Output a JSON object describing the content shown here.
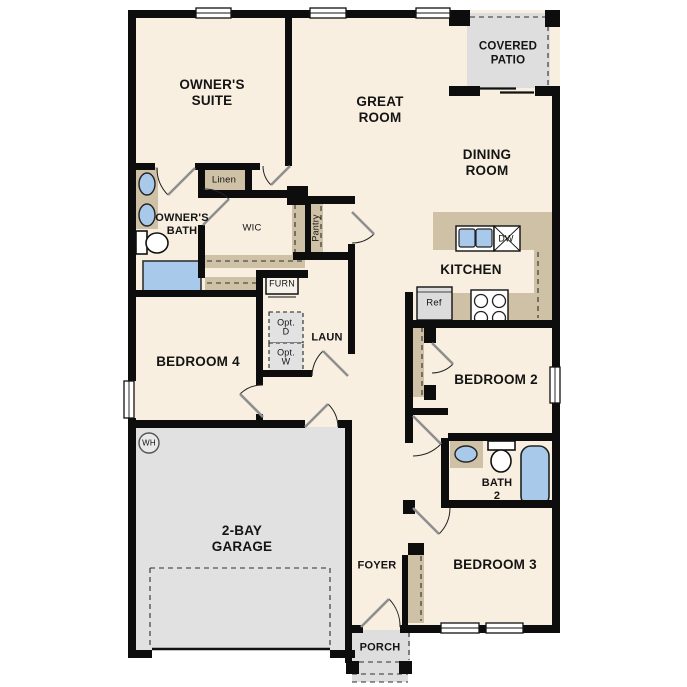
{
  "colors": {
    "floor": "#f8efe1",
    "wall": "#0d0d0d",
    "counter_tan": "#cfc1a6",
    "garage_gray": "#e1e1e1",
    "patio_gray": "#dedede",
    "fixture_blue": "#a9c9ea",
    "appliance_gray": "#dcdcdc",
    "door_leaf_gray": "#8f8f8f"
  },
  "labels": {
    "owners_suite": "OWNER'S\nSUITE",
    "great_room": "GREAT\nROOM",
    "covered_patio": "COVERED\nPATIO",
    "dining_room": "DINING\nROOM",
    "kitchen": "KITCHEN",
    "owners_bath": "OWNER'S\nBATH",
    "wic": "WIC",
    "linen": "Linen",
    "pantry": "Pantry",
    "furn": "FURN",
    "opt_d": "Opt.\nD",
    "opt_w": "Opt.\nW",
    "laun": "LAUN",
    "bedroom4": "BEDROOM 4",
    "bedroom2": "BEDROOM 2",
    "bedroom3": "BEDROOM 3",
    "bath2": "BATH\n2",
    "garage": "2-BAY\nGARAGE",
    "foyer": "FOYER",
    "porch": "PORCH",
    "ref": "Ref",
    "dw": "DW",
    "wh": "WH"
  }
}
